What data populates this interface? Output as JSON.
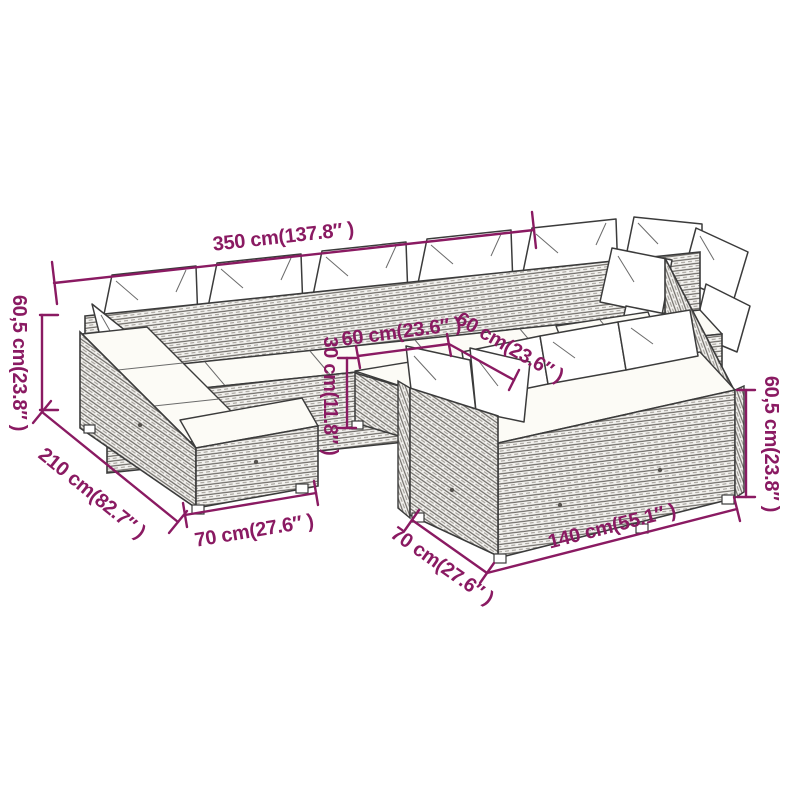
{
  "diagram": {
    "type": "product-dimension-diagram",
    "subject": "rattan garden lounge furniture set (U-shaped sectional with corner table)",
    "background_color": "#ffffff",
    "accent_color": "#8a1a62",
    "furniture_line_color": "#3b3b3b",
    "dimensions": {
      "total_width": {
        "label": "350 cm(137.8″ )",
        "meaning": "overall width of back row"
      },
      "left_height": {
        "label": "60,5 cm(23.8″ )",
        "meaning": "height of left-side sofa"
      },
      "left_depth": {
        "label": "210 cm(82.7″ )",
        "meaning": "overall depth of left arm"
      },
      "left_end_width": {
        "label": "70 cm(27.6″ )",
        "meaning": "width of left arm end section"
      },
      "table_width": {
        "label": "60 cm(23.6″ )",
        "meaning": "table width"
      },
      "table_depth": {
        "label": "60 cm(23.6″ )",
        "meaning": "table depth"
      },
      "table_height": {
        "label": "30 cm(11.8″ )",
        "meaning": "table height"
      },
      "front_depth": {
        "label": "70 cm(27.6″ )",
        "meaning": "depth of front sofa section"
      },
      "front_width": {
        "label": "140 cm(55.1″ )",
        "meaning": "width of front sofa section"
      },
      "right_height": {
        "label": "60,5 cm(23.8″ )",
        "meaning": "height of right-side sofa"
      }
    }
  }
}
